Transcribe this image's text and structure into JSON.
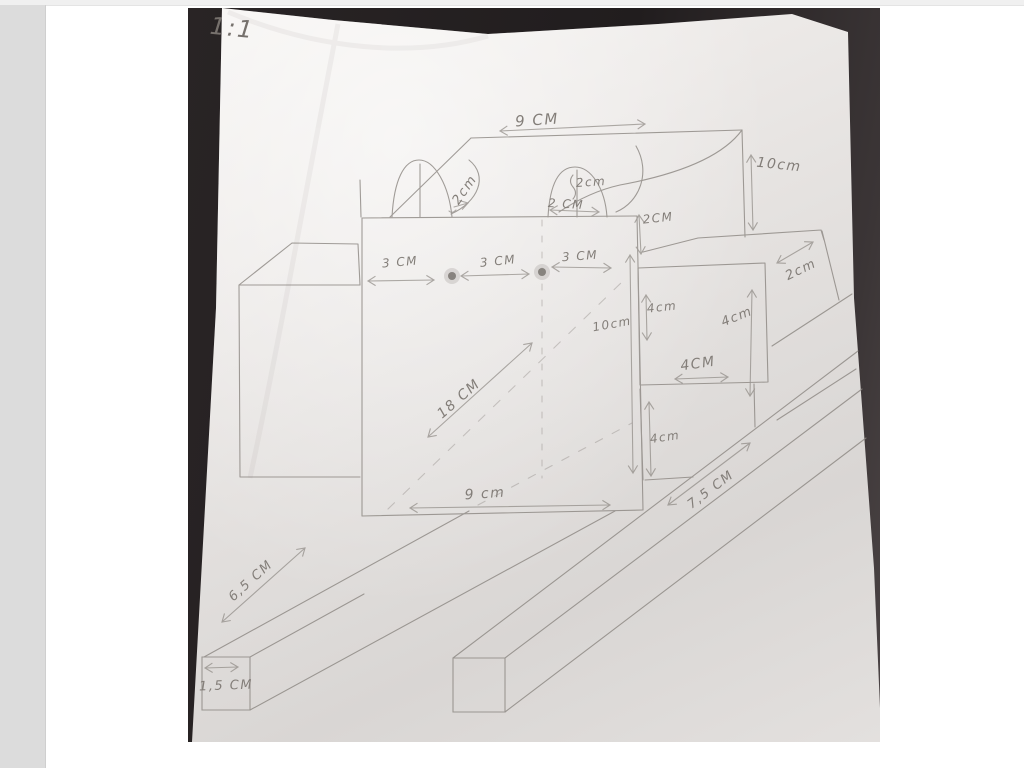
{
  "photo": {
    "scale_note": "1:1",
    "labels": [
      {
        "name": "dim-9cm-top",
        "text": "9 CM",
        "x": 349,
        "y": 112,
        "rot": -4,
        "size": 15
      },
      {
        "name": "dim-10cm-roof",
        "text": "10cm",
        "x": 591,
        "y": 157,
        "rot": 6,
        "size": 14
      },
      {
        "name": "dim-2cm-arch1",
        "text": "2cm",
        "x": 277,
        "y": 182,
        "rot": -55,
        "size": 13
      },
      {
        "name": "dim-2cm-arch2-height",
        "text": "2cm",
        "x": 403,
        "y": 174,
        "rot": -4,
        "size": 12
      },
      {
        "name": "dim-2cm-arch2-width",
        "text": "2 CM",
        "x": 378,
        "y": 196,
        "rot": 3,
        "size": 12
      },
      {
        "name": "dim-2cm-fold",
        "text": "2CM",
        "x": 470,
        "y": 210,
        "rot": -6,
        "size": 12
      },
      {
        "name": "dim-2cm-depth",
        "text": "2cm",
        "x": 613,
        "y": 262,
        "rot": -26,
        "size": 13
      },
      {
        "name": "dim-3cm-a",
        "text": "3 CM",
        "x": 212,
        "y": 254,
        "rot": -5,
        "size": 12
      },
      {
        "name": "dim-3cm-b",
        "text": "3 CM",
        "x": 310,
        "y": 253,
        "rot": -6,
        "size": 12
      },
      {
        "name": "dim-3cm-c",
        "text": "3 CM",
        "x": 392,
        "y": 248,
        "rot": -4,
        "size": 12
      },
      {
        "name": "dim-10cm-inner",
        "text": "10cm",
        "x": 424,
        "y": 316,
        "rot": -10,
        "size": 12
      },
      {
        "name": "dim-4cm-left",
        "text": "4cm",
        "x": 474,
        "y": 299,
        "rot": -6,
        "size": 12
      },
      {
        "name": "dim-4cm-right",
        "text": "4cm",
        "x": 549,
        "y": 309,
        "rot": -22,
        "size": 13
      },
      {
        "name": "dim-4cm-width",
        "text": "4CM",
        "x": 510,
        "y": 356,
        "rot": -8,
        "size": 14
      },
      {
        "name": "dim-4cm-lower",
        "text": "4cm",
        "x": 477,
        "y": 429,
        "rot": -8,
        "size": 12
      },
      {
        "name": "dim-7-5cm",
        "text": "7,5 CM",
        "x": 523,
        "y": 482,
        "rot": -37,
        "size": 13
      },
      {
        "name": "dim-9cm-bottom",
        "text": "9 cm",
        "x": 297,
        "y": 486,
        "rot": -4,
        "size": 14
      },
      {
        "name": "dim-18cm",
        "text": "18 CM",
        "x": 271,
        "y": 391,
        "rot": -41,
        "size": 14
      },
      {
        "name": "dim-6-5cm",
        "text": "6,5 CM",
        "x": 63,
        "y": 573,
        "rot": -42,
        "size": 13
      },
      {
        "name": "dim-1-5cm",
        "text": "1,5 CM",
        "x": 38,
        "y": 678,
        "rot": -2,
        "size": 13
      }
    ]
  },
  "colors": {
    "page_background": "#ffffff",
    "top_strip": "#f0f0f0",
    "left_strip": "#dcdcdc",
    "photo_backdrop": "#241f20",
    "paper": "#e5e2e0",
    "pencil": "#8b8681"
  }
}
